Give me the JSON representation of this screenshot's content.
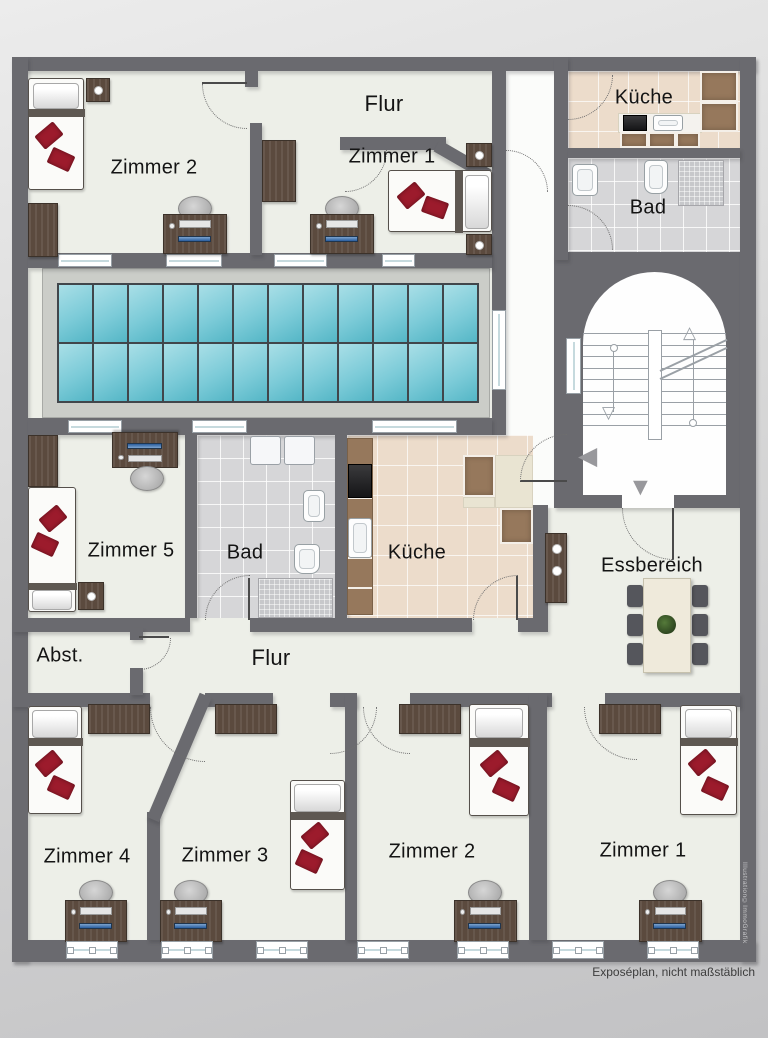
{
  "labels": {
    "flur_top": "Flur",
    "zimmer2_top": "Zimmer 2",
    "zimmer1_top": "Zimmer 1",
    "kueche_top": "Küche",
    "bad_top": "Bad",
    "zimmer5": "Zimmer 5",
    "bad_mid": "Bad",
    "kueche_mid": "Küche",
    "essbereich": "Essbereich",
    "abst": "Abst.",
    "flur_mid": "Flur",
    "zimmer4": "Zimmer 4",
    "zimmer3": "Zimmer 3",
    "zimmer2_bottom": "Zimmer 2",
    "zimmer1_bottom": "Zimmer 1"
  },
  "footer": {
    "disclaimer": "Exposéplan, nicht maßstäblich",
    "credit": "Illustration©ImmoGrafik"
  },
  "skylight": {
    "rows": 2,
    "cols": 12
  },
  "stairs": {
    "flights": 2,
    "treads_per_flight": 9
  },
  "colors": {
    "wall": "#6a6a6f",
    "floor": "#edefe8",
    "hall": "#fbfcfa",
    "sky1": "#a9dfe7",
    "sky2": "#54b6c6",
    "ktile": "#ecdccb",
    "btile": "#d6d6d8",
    "wood": "#5b4a3e",
    "counter": "#96785c",
    "cream": "#e9e4d2",
    "red": "#9c1b2c",
    "table": "#efeadb",
    "chair": "#55565c",
    "stair": "#9aa0a6",
    "arrow": "#98989c"
  }
}
